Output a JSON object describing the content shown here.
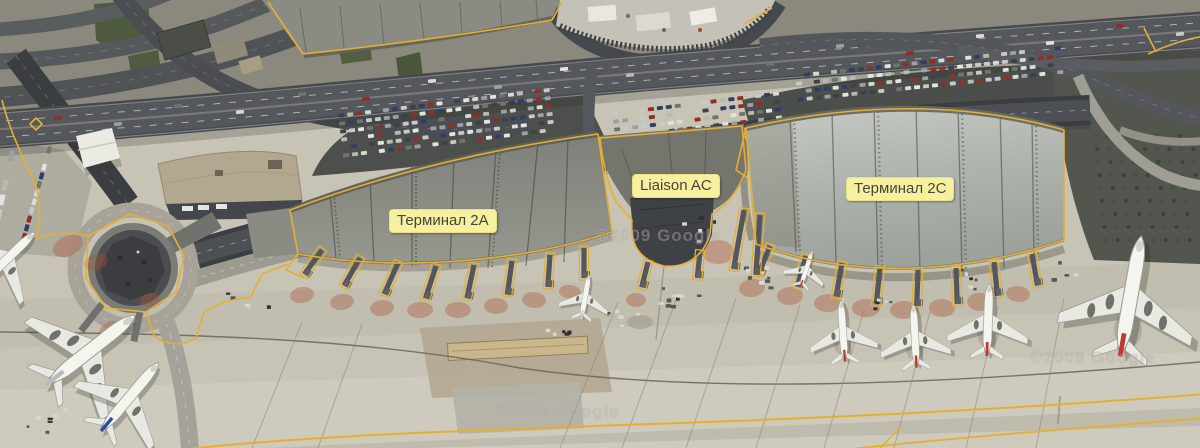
{
  "map": {
    "labels": [
      {
        "id": "terminal-2a",
        "text": "Терминал 2A",
        "x": 389,
        "y": 209
      },
      {
        "id": "liaison-ac",
        "text": "Liaison AC",
        "x": 632,
        "y": 174
      },
      {
        "id": "terminal-2c",
        "text": "Терминал 2C",
        "x": 846,
        "y": 177
      }
    ],
    "watermarks": [
      {
        "text": "©2009 Google",
        "x": 596,
        "y": 226
      },
      {
        "text": "©2009 Google",
        "x": 494,
        "y": 402
      },
      {
        "text": "©2009 Google",
        "x": 1030,
        "y": 348
      }
    ],
    "colors": {
      "annotation_yellow": "#e5b02f",
      "label_bg": "#f7f09e",
      "label_border": "#eae289",
      "label_text": "#45453f",
      "apron": "#c7c3b5"
    }
  }
}
